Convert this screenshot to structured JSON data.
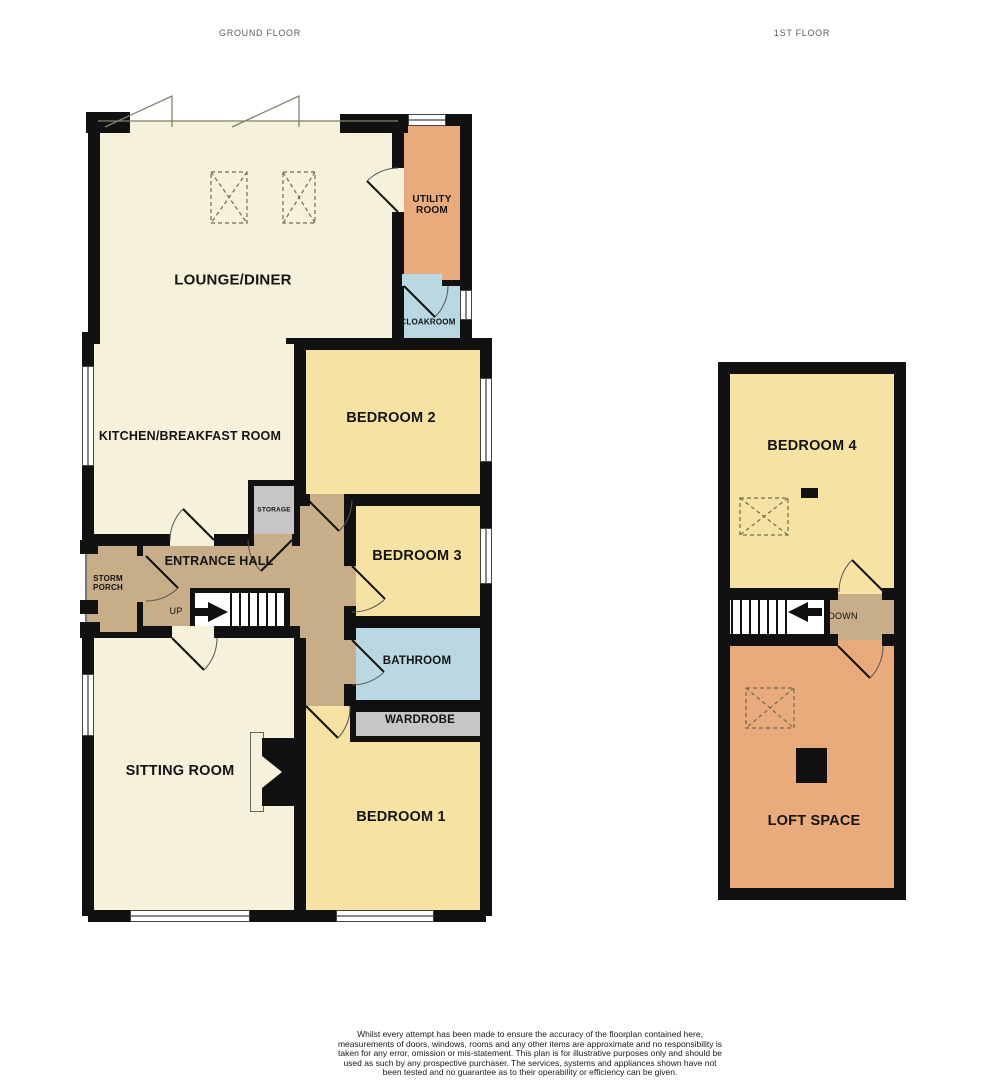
{
  "titles": {
    "ground_floor": "GROUND FLOOR",
    "first_floor": "1ST FLOOR"
  },
  "rooms": {
    "lounge_diner": "LOUNGE/DINER",
    "utility_room": "UTILITY ROOM",
    "cloakroom": "CLOAKROOM",
    "kitchen_breakfast": "KITCHEN/BREAKFAST ROOM",
    "bedroom2": "BEDROOM 2",
    "bedroom3": "BEDROOM 3",
    "storage": "STORAGE",
    "entrance_hall": "ENTRANCE HALL",
    "storm_porch": "STORM PORCH",
    "bathroom": "BATHROOM",
    "wardrobe": "WARDROBE",
    "sitting_room": "SITTING ROOM",
    "bedroom1": "BEDROOM 1",
    "bedroom4": "BEDROOM 4",
    "loft_space": "LOFT SPACE"
  },
  "stairs": {
    "up": "UP",
    "down": "DOWN"
  },
  "footer": {
    "disclaimer": "Whilst every attempt has been made to ensure the accuracy of the floorplan contained here, measurements of doors, windows, rooms and any other items are approximate and no responsibility is taken for any error, omission or mis-statement. This plan is for illustrative purposes only and should be used as such by any prospective purchaser. The services, systems and appliances shown have not been tested and no guarantee as to their operability or efficiency can be given.",
    "credit": "Made with Metropix ©2025"
  },
  "palette": {
    "cream": "#f6f1da",
    "yellow": "#f6e3a3",
    "orange": "#eaab7c",
    "blue": "#b9d8e1",
    "tan": "#c7ad88",
    "gray": "#c6c6c6",
    "wall": "#111111"
  }
}
